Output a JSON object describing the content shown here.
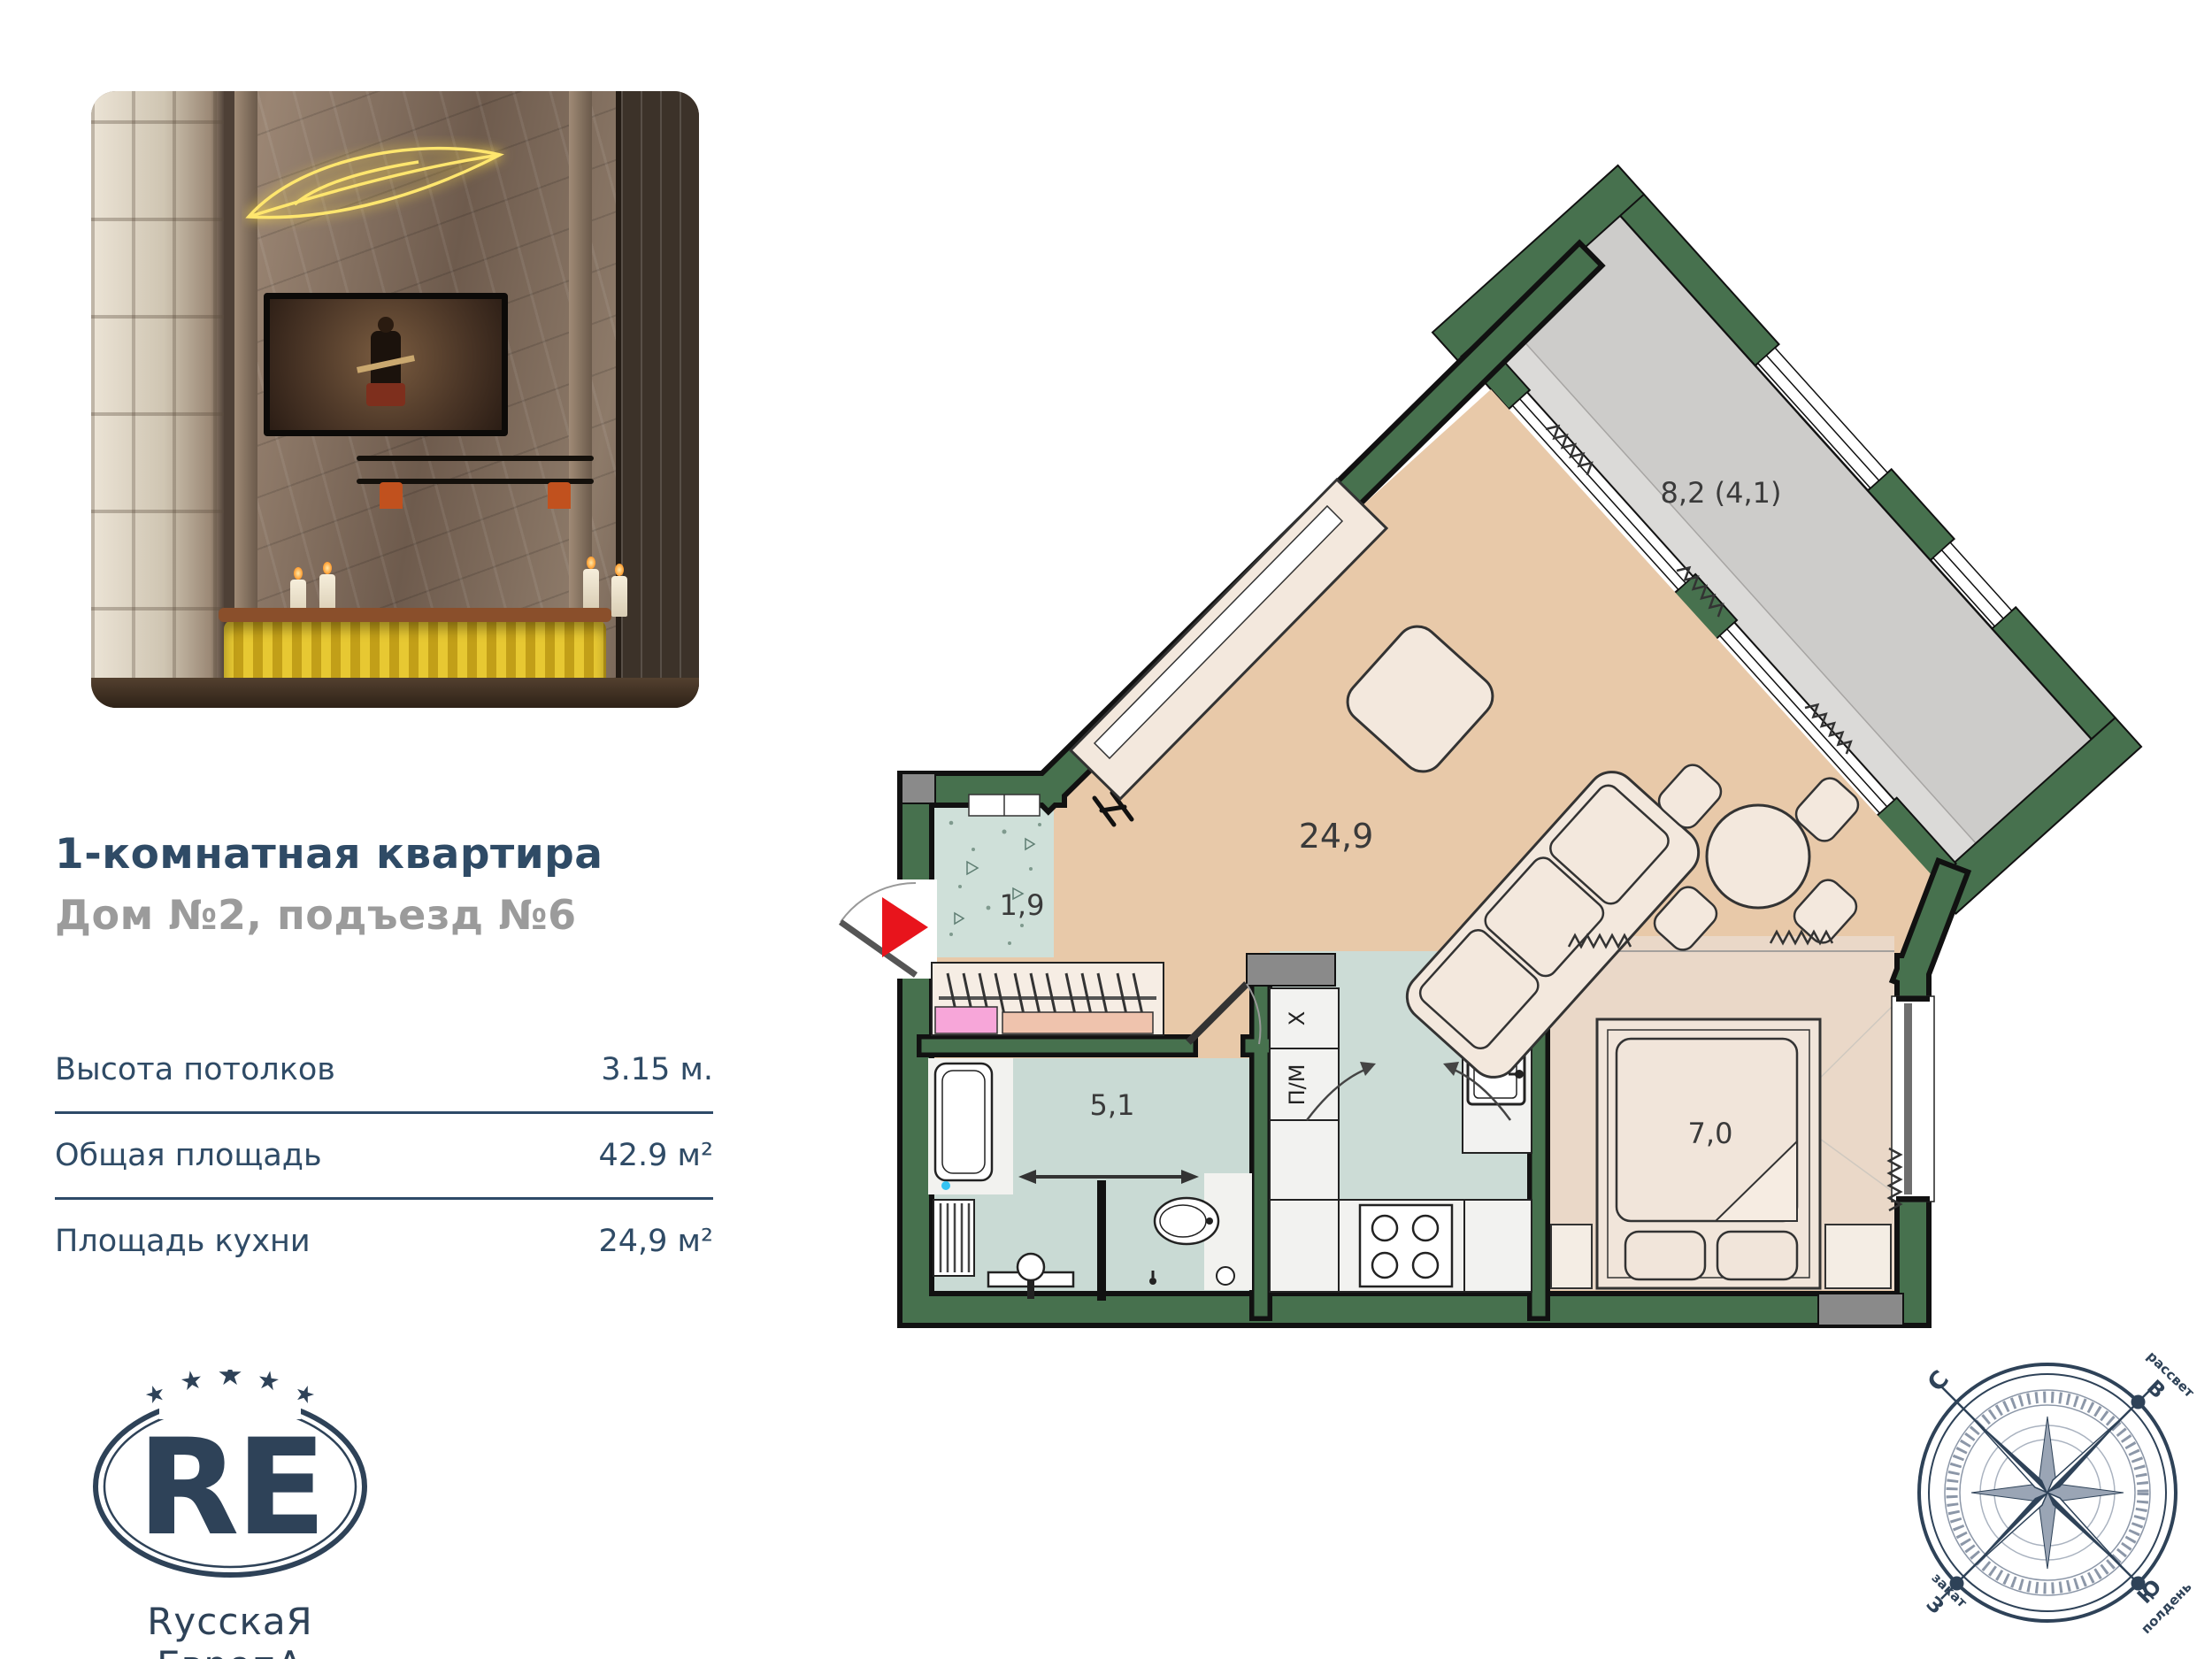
{
  "listing": {
    "title": "1-комнатная квартира",
    "subtitle": "Дом №2, подъезд №6",
    "specs": [
      {
        "label": "Высота потолков",
        "value": "3.15 м."
      },
      {
        "label": "Общая площадь",
        "value": "42.9 м²"
      },
      {
        "label": "Площадь кухни",
        "value": "24,9 м²"
      }
    ]
  },
  "logo": {
    "monogram": "RE",
    "star": "★",
    "name": "RусскаЯ ЕвропА",
    "city": "Калининград"
  },
  "plan": {
    "rooms": {
      "living": {
        "name": "кухня-гостиная",
        "area": "24,9"
      },
      "hall": {
        "name": "прихожая",
        "area": "1,9"
      },
      "bath": {
        "name": "санузел",
        "area": "5,1"
      },
      "bedroom": {
        "name": "спальная ниша",
        "area": "7,0"
      },
      "balcony": {
        "name": "лоджия",
        "area": "8,2 (4,1)"
      }
    },
    "kitchen": {
      "fridge": "Х",
      "dishwasher": "П/М"
    },
    "colors": {
      "wall_green": "#47714e",
      "floor_main": "#e8c9a9",
      "floor_wet": "#ccdcd6",
      "floor_bedroom": "#ead8c8",
      "balcony_floor": "#cdccca",
      "entrance_arrow": "#e8141c",
      "brand_navy": "#2e4258"
    }
  },
  "compass": {
    "north": "С",
    "east": "В",
    "west": "З",
    "south": "Ю",
    "dawn": "рассвет",
    "sunset": "закат",
    "noon": "полдень"
  }
}
